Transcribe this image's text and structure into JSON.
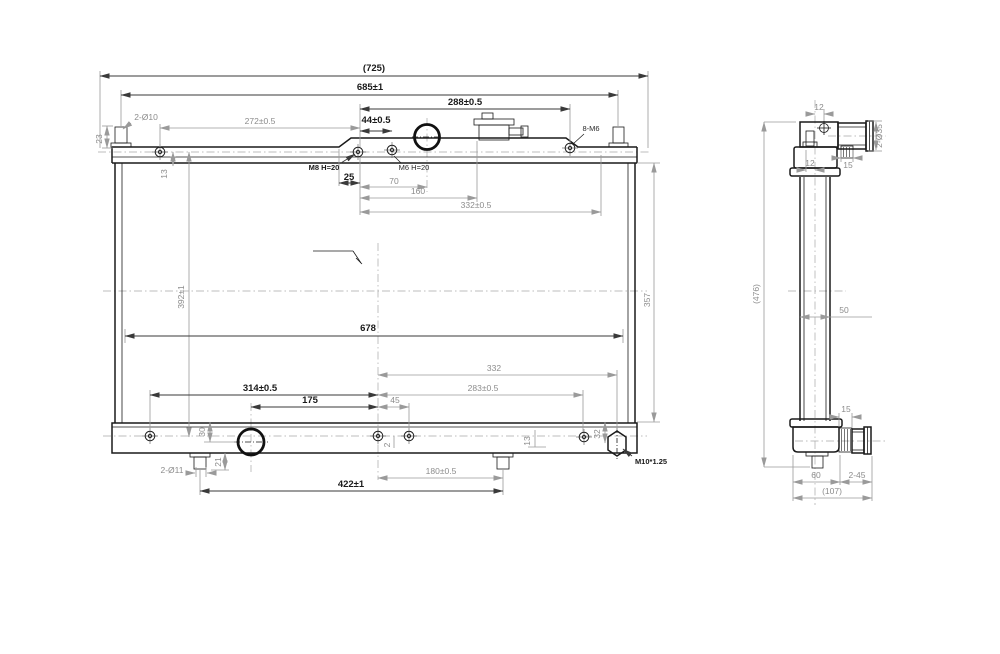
{
  "front": {
    "d725": "(725)",
    "d685": "685±1",
    "d288": "288±0.5",
    "d2x10": "2-Ø10",
    "d272": "272±0.5",
    "d44": "44±0.5",
    "d8m6": "8-M6",
    "d23": "23",
    "d13": "13",
    "m8": "M8 H=20",
    "m6": "M6 H=20",
    "d25": "25",
    "d70": "70",
    "d160": "160",
    "d332a": "332±0.5",
    "d392": "392±1",
    "d357": "357",
    "d678": "678",
    "d332b": "332",
    "d283": "283±0.5",
    "d314": "314±0.5",
    "d175": "175",
    "d45": "45",
    "d30": "30",
    "d21": "21",
    "d2x11": "2-Ø11",
    "d422": "422±1",
    "d180": "180±0.5",
    "d13b": "13",
    "d2": "2",
    "d32": "32",
    "m10": "M10*1.25"
  },
  "side": {
    "d12a": "12",
    "d2x35": "2-Ø35",
    "d15a": "15",
    "d12b": "12",
    "d476": "(476)",
    "d50": "50",
    "d15b": "15",
    "d60": "60",
    "d45x2": "2-45",
    "d107": "(107)"
  },
  "colors": {
    "line": "#1a1a1a",
    "dim": "#8c8c8c",
    "background": "#ffffff"
  }
}
